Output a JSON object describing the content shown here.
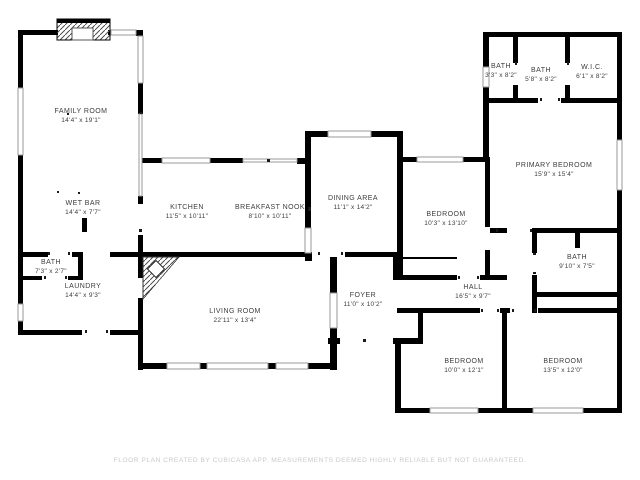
{
  "colors": {
    "wall": "#000000",
    "room_text": "#3d3d3d",
    "footer_text": "#c9c9c9",
    "window_outline": "#9a9a9a"
  },
  "rooms": [
    {
      "id": "family-room",
      "name": "FAMILY ROOM",
      "dims": "14'4\" x 19'1\"",
      "cx": 81,
      "cy": 112
    },
    {
      "id": "wet-bar",
      "name": "WET BAR",
      "dims": "14'4\" x 7'7\"",
      "cx": 83,
      "cy": 204
    },
    {
      "id": "kitchen",
      "name": "KITCHEN",
      "dims": "11'5\" x 10'11\"",
      "cx": 187,
      "cy": 208
    },
    {
      "id": "breakfast-nook",
      "name": "BREAKFAST NOOK",
      "dims": "8'10\" x 10'11\"",
      "cx": 270,
      "cy": 208
    },
    {
      "id": "dining-area",
      "name": "DINING AREA",
      "dims": "11'1\" x 14'2\"",
      "cx": 353,
      "cy": 199
    },
    {
      "id": "bedroom-mid",
      "name": "BEDROOM",
      "dims": "10'3\" x 13'10\"",
      "cx": 446,
      "cy": 215
    },
    {
      "id": "primary-bedroom",
      "name": "PRIMARY BEDROOM",
      "dims": "15'9\" x 15'4\"",
      "cx": 554,
      "cy": 166
    },
    {
      "id": "bath-small",
      "name": "BATH",
      "dims": "3'3\" x 8'2\"",
      "cx": 501,
      "cy": 67
    },
    {
      "id": "bath-hall-top",
      "name": "BATH",
      "dims": "5'8\" x 8'2\"",
      "cx": 541,
      "cy": 71
    },
    {
      "id": "wic",
      "name": "W.I.C.",
      "dims": "6'1\" x 8'2\"",
      "cx": 592,
      "cy": 68
    },
    {
      "id": "bath-right",
      "name": "BATH",
      "dims": "9'10\" x 7'5\"",
      "cx": 577,
      "cy": 258
    },
    {
      "id": "hall",
      "name": "HALL",
      "dims": "16'5\" x 9'7\"",
      "cx": 473,
      "cy": 288
    },
    {
      "id": "foyer",
      "name": "FOYER",
      "dims": "11'0\" x 10'2\"",
      "cx": 363,
      "cy": 296
    },
    {
      "id": "living-room",
      "name": "LIVING ROOM",
      "dims": "22'11\" x 13'4\"",
      "cx": 235,
      "cy": 312
    },
    {
      "id": "laundry",
      "name": "LAUNDRY",
      "dims": "14'4\" x 9'3\"",
      "cx": 83,
      "cy": 287
    },
    {
      "id": "bath-powder",
      "name": "BATH",
      "dims": "7'3\" x 2'7\"",
      "cx": 51,
      "cy": 263
    },
    {
      "id": "bedroom-sw",
      "name": "BEDROOM",
      "dims": "10'0\" x 12'1\"",
      "cx": 464,
      "cy": 362
    },
    {
      "id": "bedroom-se",
      "name": "BEDROOM",
      "dims": "13'5\" x 12'0\"",
      "cx": 563,
      "cy": 362
    }
  ],
  "footer": {
    "text": "FLOOR PLAN CREATED BY CUBICASA APP. MEASUREMENTS DEEMED HIGHLY RELIABLE BUT NOT GUARANTEED."
  }
}
